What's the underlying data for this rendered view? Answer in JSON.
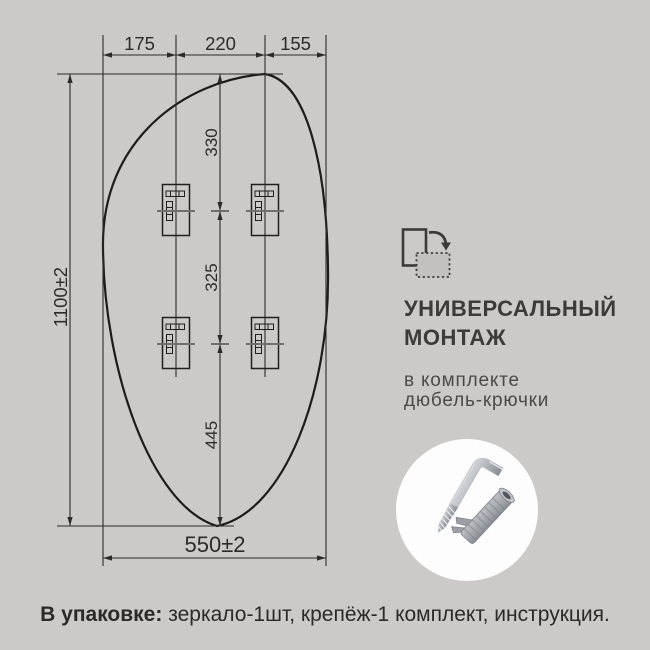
{
  "colors": {
    "background": "#cbcac8",
    "drawing_line": "#2b2b2b",
    "centerline_gray": "#6f6f6f",
    "title_text": "#3b3b3b",
    "subtitle_text": "#4a4a4a",
    "footer_text": "#2a2a2a",
    "circle_background": "#fdfdfd"
  },
  "drawing": {
    "dimensions": {
      "top_widths": [
        "175",
        "220",
        "155"
      ],
      "vertical_spacings": [
        "330",
        "325",
        "445"
      ],
      "total_height": "1100±2",
      "total_width": "550±2"
    }
  },
  "right_panel": {
    "mount_icon": "rotate-orientation-icon",
    "title_line1": "УНИВЕРСАЛЬНЫЙ",
    "title_line2": "МОНТАЖ",
    "subtitle_line1": "в комплекте",
    "subtitle_line2": "дюбель-крючки",
    "hardware_image": "hook-and-dowel-photo"
  },
  "footer": {
    "label_bold": "В упаковке:",
    "label_rest": " зеркало-1шт, крепёж-1 комплект, инструкция."
  }
}
